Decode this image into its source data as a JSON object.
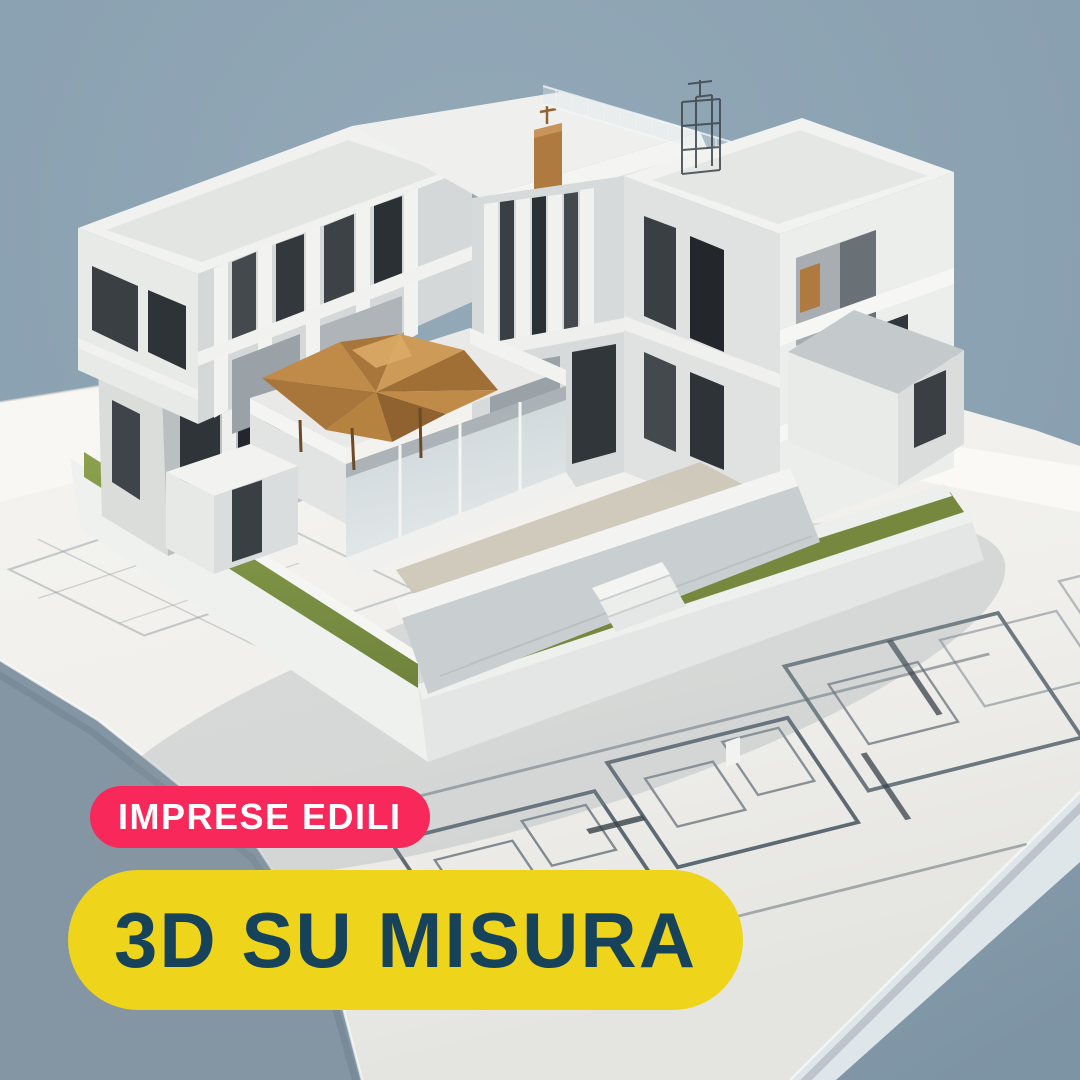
{
  "poster": {
    "badges": {
      "category": {
        "label": "IMPRESE EDILI",
        "bg": "#F8285A",
        "fg": "#FFFFFF"
      },
      "headline": {
        "label": "3D SU MISURA",
        "bg": "#EFD41C",
        "fg": "#17435A"
      }
    },
    "colors": {
      "backdrop": "#8BA2B2",
      "table": "#7E95A5",
      "paper": "#F2F1ED",
      "grass": "#7E9347",
      "wood_canopy": "#C08A49",
      "model_white": "#F2F3F1"
    }
  }
}
